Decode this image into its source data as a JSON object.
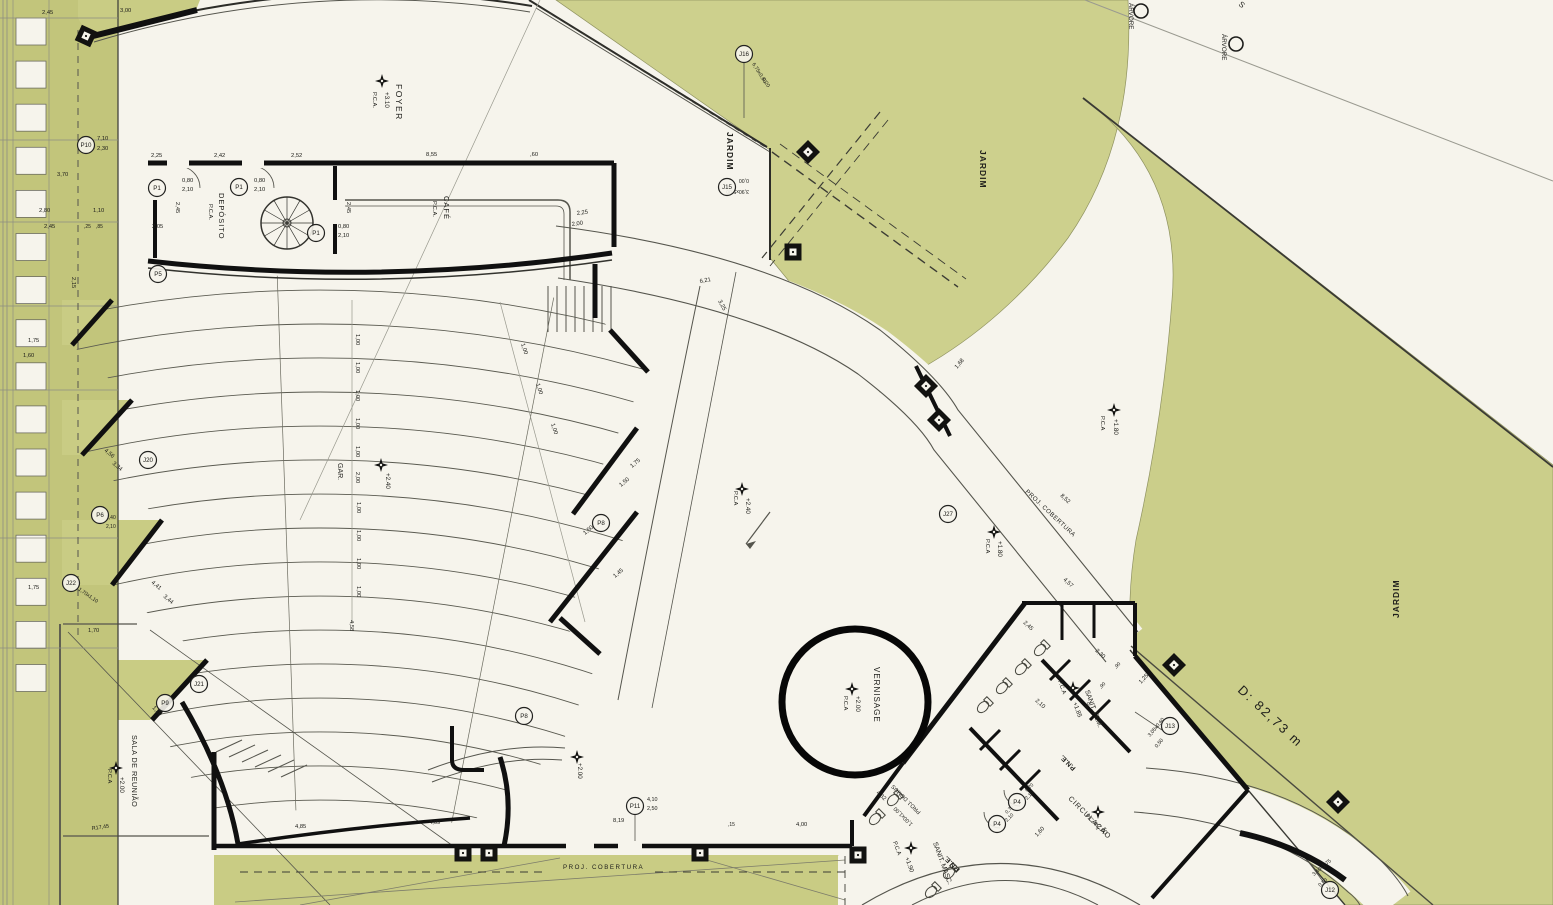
{
  "plan": {
    "colors": {
      "paper": "#f6f4ec",
      "green": "#c9cc84",
      "green_light": "#cdd08d",
      "green_dark": "#c2c57b",
      "ink": "#141414",
      "line": "#4a4a4a",
      "dim_text": "#2b2b26"
    },
    "distance_note": "D: 82,73 m",
    "rooms": [
      "FOYER",
      "DEPÓSITO",
      "CAFÉ",
      "GAR.",
      "JARDIM",
      "VERNISAGE",
      "SALA DE REUNIÃO",
      "SANIT. FEM.",
      "SANIT. MASC.",
      "P.N.E.",
      "CIRCULAÇÃO"
    ],
    "texts": [
      {
        "t": "FOYER",
        "x": 396,
        "y": 84,
        "r": 90,
        "s": 8.5,
        "ls": 1.5
      },
      {
        "t": "+3.10",
        "x": 385,
        "y": 92,
        "r": 90,
        "s": 6.3
      },
      {
        "t": "P.C.A.",
        "x": 373,
        "y": 92,
        "r": 90,
        "s": 5.8
      },
      {
        "t": "DEPÓSITO",
        "x": 219,
        "y": 193,
        "r": 90,
        "s": 7.5,
        "ls": 1
      },
      {
        "t": "P.C.A.",
        "x": 209,
        "y": 204,
        "r": 90,
        "s": 5.8
      },
      {
        "t": "CAFÉ",
        "x": 444,
        "y": 196,
        "r": 90,
        "s": 7.5,
        "ls": 1
      },
      {
        "t": "P.C.A.",
        "x": 433,
        "y": 201,
        "r": 90,
        "s": 5.8
      },
      {
        "t": "GAR.",
        "x": 338,
        "y": 463,
        "r": 90,
        "s": 7
      },
      {
        "t": "+2.40",
        "x": 386,
        "y": 473,
        "r": 90,
        "s": 6.3
      },
      {
        "t": "JARDIM",
        "x": 727,
        "y": 132,
        "r": 90,
        "s": 8.5,
        "w": "bold",
        "ls": 1
      },
      {
        "t": "JARDIM",
        "x": 980,
        "y": 150,
        "r": 90,
        "s": 8.5,
        "w": "bold",
        "ls": 1
      },
      {
        "t": "JARDIM",
        "x": 1399,
        "y": 618,
        "r": -90,
        "s": 8.5,
        "w": "bold",
        "ls": 1
      },
      {
        "t": "ÁRVORE",
        "x": 1129,
        "y": 3,
        "r": 90,
        "s": 6.3
      },
      {
        "t": "ÁRVORE",
        "x": 1222,
        "y": 34,
        "r": 90,
        "s": 6.3
      },
      {
        "t": "VERNISAGE",
        "x": 874,
        "y": 667,
        "r": 90,
        "s": 8,
        "ls": 1
      },
      {
        "t": "+2.00",
        "x": 856,
        "y": 696,
        "r": 90,
        "s": 6.3
      },
      {
        "t": "P.C.A",
        "x": 844,
        "y": 696,
        "r": 90,
        "s": 5.8
      },
      {
        "t": "SALA DE REUNIÃO",
        "x": 132,
        "y": 735,
        "r": 90,
        "s": 7.2,
        "ls": 0.5
      },
      {
        "t": "+2.00",
        "x": 120,
        "y": 777,
        "r": 90,
        "s": 6.3
      },
      {
        "t": "P.C.A",
        "x": 108,
        "y": 769,
        "r": 90,
        "s": 5.8
      },
      {
        "t": "SANIT. FEM.",
        "x": 1085,
        "y": 691,
        "r": 70,
        "s": 6.8
      },
      {
        "t": "+1.85",
        "x": 1073,
        "y": 703,
        "r": 70,
        "s": 6.2
      },
      {
        "t": "P.C.A",
        "x": 1058,
        "y": 681,
        "r": 70,
        "s": 5.8
      },
      {
        "t": "SANIT. MASC.",
        "x": 933,
        "y": 843,
        "r": 70,
        "s": 6.8
      },
      {
        "t": "+1.90",
        "x": 905,
        "y": 858,
        "r": 70,
        "s": 6.2
      },
      {
        "t": "P.C.A",
        "x": 893,
        "y": 842,
        "r": 70,
        "s": 5.8
      },
      {
        "t": "P.N.E.",
        "x": 1076,
        "y": 768,
        "r": -135,
        "s": 6.8,
        "w": "bold"
      },
      {
        "t": "P.N.E.",
        "x": 960,
        "y": 869,
        "r": -135,
        "s": 6.8,
        "w": "bold"
      },
      {
        "t": "CIRCULAÇÃO",
        "x": 1068,
        "y": 799,
        "r": 45,
        "s": 7.2,
        "ls": 1
      },
      {
        "t": "+2.00",
        "x": 1094,
        "y": 824,
        "r": 45,
        "s": 6.2
      },
      {
        "t": "P.C.A",
        "x": 1085,
        "y": 816,
        "r": 45,
        "s": 5.8
      },
      {
        "t": "PROJ. DOMUS",
        "x": 921,
        "y": 812,
        "r": -135,
        "s": 5.6
      },
      {
        "t": "1,00x1,00",
        "x": 913,
        "y": 824,
        "r": -135,
        "s": 5.6
      },
      {
        "t": "PROJ. COBERTURA",
        "x": 563,
        "y": 869,
        "r": 0,
        "s": 6.2,
        "ls": 1.5
      },
      {
        "t": "PROJ. COBERTURA",
        "x": 1025,
        "y": 492,
        "r": 43,
        "s": 6.2,
        "ls": 0.5
      },
      {
        "t": "+2.00",
        "x": 578,
        "y": 763,
        "r": 90,
        "s": 6.2
      },
      {
        "t": "P.C.A",
        "x": 734,
        "y": 491,
        "r": 90,
        "s": 5.8
      },
      {
        "t": "+2.40",
        "x": 746,
        "y": 498,
        "r": 90,
        "s": 6.3
      },
      {
        "t": "P.C.A",
        "x": 1101,
        "y": 416,
        "r": 90,
        "s": 5.8
      },
      {
        "t": "+1.80",
        "x": 1114,
        "y": 419,
        "r": 90,
        "s": 6.3
      },
      {
        "t": "P.C.A",
        "x": 986,
        "y": 539,
        "r": 90,
        "s": 5.8
      },
      {
        "t": "+1.80",
        "x": 998,
        "y": 541,
        "r": 90,
        "s": 6.3
      },
      {
        "t": "D: 82,73 m",
        "x": 1237,
        "y": 691,
        "r": 43,
        "s": 13,
        "c": "#55523d",
        "ls": 2
      },
      {
        "t": "S",
        "x": 1238,
        "y": 5,
        "r": 40,
        "s": 8,
        "c": "#777770"
      },
      {
        "t": "2,45",
        "x": 42,
        "y": 14
      },
      {
        "t": "3,00",
        "x": 120,
        "y": 12
      },
      {
        "t": "7,10",
        "x": 97,
        "y": 140
      },
      {
        "t": "2,30",
        "x": 97,
        "y": 150
      },
      {
        "t": "3,70",
        "x": 57,
        "y": 176
      },
      {
        "t": "2,80",
        "x": 39,
        "y": 212
      },
      {
        "t": "1,10",
        "x": 93,
        "y": 212
      },
      {
        "t": "2,45",
        "x": 44,
        "y": 228
      },
      {
        "t": ",25",
        "x": 84,
        "y": 228,
        "s": 5
      },
      {
        "t": ",85",
        "x": 96,
        "y": 228,
        "s": 5
      },
      {
        "t": "2,15",
        "x": 72,
        "y": 277,
        "r": 90
      },
      {
        "t": "1,75",
        "x": 28,
        "y": 342
      },
      {
        "t": "1,60",
        "x": 23,
        "y": 357
      },
      {
        "t": "2,25",
        "x": 151,
        "y": 157
      },
      {
        "t": "2,42",
        "x": 214,
        "y": 157
      },
      {
        "t": "2,52",
        "x": 291,
        "y": 157
      },
      {
        "t": "8,55",
        "x": 426,
        "y": 156
      },
      {
        "t": ",60",
        "x": 530,
        "y": 156
      },
      {
        "t": "0,80",
        "x": 182,
        "y": 182
      },
      {
        "t": "2,10",
        "x": 182,
        "y": 191
      },
      {
        "t": "0,80",
        "x": 254,
        "y": 182
      },
      {
        "t": "2,10",
        "x": 254,
        "y": 191
      },
      {
        "t": "0,80",
        "x": 338,
        "y": 228
      },
      {
        "t": "2,10",
        "x": 338,
        "y": 237
      },
      {
        "t": "2,05",
        "x": 152,
        "y": 228
      },
      {
        "t": "2,45",
        "x": 176,
        "y": 202,
        "r": 90
      },
      {
        "t": "2,45",
        "x": 347,
        "y": 202,
        "r": 90
      },
      {
        "t": "2,25",
        "x": 577,
        "y": 215,
        "r": -8
      },
      {
        "t": "2,00",
        "x": 572,
        "y": 226,
        "r": -8
      },
      {
        "t": "6,21",
        "x": 700,
        "y": 283,
        "r": -10
      },
      {
        "t": "3,25",
        "x": 718,
        "y": 301,
        "r": 62
      },
      {
        "t": "1,00",
        "x": 356,
        "y": 334,
        "r": 90
      },
      {
        "t": "1,00",
        "x": 356,
        "y": 362,
        "r": 90
      },
      {
        "t": "1,00",
        "x": 356,
        "y": 390,
        "r": 90
      },
      {
        "t": "1,00",
        "x": 356,
        "y": 418,
        "r": 90
      },
      {
        "t": "1,00",
        "x": 356,
        "y": 446,
        "r": 90
      },
      {
        "t": "2,00",
        "x": 356,
        "y": 472,
        "r": 90
      },
      {
        "t": "1,00",
        "x": 357,
        "y": 502,
        "r": 90
      },
      {
        "t": "1,00",
        "x": 357,
        "y": 530,
        "r": 90
      },
      {
        "t": "1,00",
        "x": 357,
        "y": 558,
        "r": 90
      },
      {
        "t": "1,00",
        "x": 357,
        "y": 586,
        "r": 90
      },
      {
        "t": "4,58",
        "x": 350,
        "y": 620,
        "r": 90
      },
      {
        "t": "1,00",
        "x": 521,
        "y": 344,
        "r": 72
      },
      {
        "t": "1,00",
        "x": 536,
        "y": 384,
        "r": 72
      },
      {
        "t": "1,00",
        "x": 551,
        "y": 424,
        "r": 72
      },
      {
        "t": "1,75",
        "x": 632,
        "y": 468,
        "r": -40
      },
      {
        "t": "1,50",
        "x": 621,
        "y": 487,
        "r": -40
      },
      {
        "t": "1,50",
        "x": 585,
        "y": 535,
        "r": -40
      },
      {
        "t": "1,45",
        "x": 615,
        "y": 578,
        "r": -40
      },
      {
        "t": "4,56",
        "x": 104,
        "y": 451,
        "r": 40
      },
      {
        "t": "3,34",
        "x": 112,
        "y": 464,
        "r": 40
      },
      {
        "t": "4,41",
        "x": 151,
        "y": 583,
        "r": 40
      },
      {
        "t": "3,44",
        "x": 163,
        "y": 597,
        "r": 40
      },
      {
        "t": "1,70x1,10",
        "x": 78,
        "y": 590,
        "r": 35,
        "s": 5.2
      },
      {
        "t": "1,70",
        "x": 88,
        "y": 632
      },
      {
        "t": "1,75",
        "x": 28,
        "y": 589
      },
      {
        "t": "1,20",
        "x": 152,
        "y": 708,
        "r": 45
      },
      {
        "t": "1,40",
        "x": 106,
        "y": 519,
        "s": 5
      },
      {
        "t": "2,10",
        "x": 106,
        "y": 528,
        "s": 5
      },
      {
        "t": "4,85",
        "x": 295,
        "y": 828
      },
      {
        "t": "4,09",
        "x": 429,
        "y": 824
      },
      {
        "t": "8,19",
        "x": 613,
        "y": 822
      },
      {
        "t": "4,00",
        "x": 796,
        "y": 826
      },
      {
        "t": ",15",
        "x": 728,
        "y": 826,
        "s": 5
      },
      {
        "t": "R17,45",
        "x": 92,
        "y": 830,
        "r": -8,
        "s": 5.4
      },
      {
        "t": "8,52",
        "x": 1060,
        "y": 496,
        "r": 43
      },
      {
        "t": "4,57",
        "x": 1063,
        "y": 580,
        "r": 43
      },
      {
        "t": "2,45",
        "x": 1023,
        "y": 623,
        "r": 43
      },
      {
        "t": "2,30",
        "x": 1095,
        "y": 651,
        "r": 43
      },
      {
        "t": "2,10",
        "x": 1035,
        "y": 701,
        "r": 43
      },
      {
        "t": "1,25",
        "x": 1141,
        "y": 684,
        "r": -47
      },
      {
        "t": ",90",
        "x": 1116,
        "y": 669,
        "r": -47,
        "s": 5
      },
      {
        "t": ",90",
        "x": 1101,
        "y": 689,
        "r": -47,
        "s": 5
      },
      {
        "t": ",90",
        "x": 1086,
        "y": 709,
        "r": -47,
        "s": 5
      },
      {
        "t": "1,60",
        "x": 1037,
        "y": 837,
        "r": -47
      },
      {
        "t": "4,32",
        "x": 876,
        "y": 793,
        "r": 43
      },
      {
        "t": "1,68",
        "x": 957,
        "y": 369,
        "r": -50
      },
      {
        "t": "6,75x0,60",
        "x": 752,
        "y": 64,
        "r": 58,
        "s": 5.2
      },
      {
        "t": "0,20",
        "x": 762,
        "y": 79,
        "r": 58,
        "s": 5.2
      },
      {
        "t": "0,00",
        "x": 749,
        "y": 179,
        "r": 180,
        "s": 5.2
      },
      {
        "t": "3,90x5,00",
        "x": 749,
        "y": 190,
        "r": 180,
        "s": 5.2
      },
      {
        "t": "3,05x0,60",
        "x": 1150,
        "y": 737,
        "r": -50,
        "s": 5.2
      },
      {
        "t": "0,50",
        "x": 1157,
        "y": 748,
        "r": -50,
        "s": 5.2
      },
      {
        "t": "3,40x1,75",
        "x": 1314,
        "y": 876,
        "r": -40,
        "s": 5.2
      },
      {
        "t": "0,50",
        "x": 1320,
        "y": 887,
        "r": -40,
        "s": 5.2
      },
      {
        "t": "4,10",
        "x": 647,
        "y": 801,
        "s": 5.4
      },
      {
        "t": "2,50",
        "x": 647,
        "y": 810,
        "s": 5.4
      },
      {
        "t": "0,70",
        "x": 1027,
        "y": 792,
        "r": -45,
        "s": 5
      },
      {
        "t": "2,10",
        "x": 1027,
        "y": 800,
        "r": -45,
        "s": 5
      },
      {
        "t": "0,70",
        "x": 1007,
        "y": 814,
        "r": -45,
        "s": 5
      },
      {
        "t": "2,10",
        "x": 1007,
        "y": 822,
        "r": -45,
        "s": 5
      }
    ],
    "tags": [
      {
        "id": "P1",
        "x": 157,
        "y": 188
      },
      {
        "id": "P1",
        "x": 239,
        "y": 187
      },
      {
        "id": "P1",
        "x": 316,
        "y": 233
      },
      {
        "id": "P5",
        "x": 158,
        "y": 274
      },
      {
        "id": "P10",
        "x": 86,
        "y": 145
      },
      {
        "id": "P6",
        "x": 100,
        "y": 515
      },
      {
        "id": "P8",
        "x": 601,
        "y": 523
      },
      {
        "id": "P8",
        "x": 524,
        "y": 716
      },
      {
        "id": "P9",
        "x": 165,
        "y": 703
      },
      {
        "id": "P11",
        "x": 635,
        "y": 806
      },
      {
        "id": "P4",
        "x": 1017,
        "y": 802
      },
      {
        "id": "P4",
        "x": 997,
        "y": 824
      },
      {
        "id": "J20",
        "x": 148,
        "y": 460
      },
      {
        "id": "J21",
        "x": 199,
        "y": 684
      },
      {
        "id": "J22",
        "x": 71,
        "y": 583
      },
      {
        "id": "J27",
        "x": 948,
        "y": 514
      },
      {
        "id": "J13",
        "x": 1170,
        "y": 726
      },
      {
        "id": "J15",
        "x": 727,
        "y": 187
      },
      {
        "id": "J16",
        "x": 744,
        "y": 54
      },
      {
        "id": "J12",
        "x": 1330,
        "y": 890
      }
    ],
    "trees": [
      {
        "label": "ÁRVORE",
        "x": 1141,
        "y": 11,
        "r": 7
      },
      {
        "label": "ÁRVORE",
        "x": 1236,
        "y": 44,
        "r": 7
      }
    ],
    "level_markers": [
      {
        "x": 382,
        "y": 81
      },
      {
        "x": 381,
        "y": 465
      },
      {
        "x": 742,
        "y": 489
      },
      {
        "x": 1114,
        "y": 410
      },
      {
        "x": 994,
        "y": 532
      },
      {
        "x": 852,
        "y": 689
      },
      {
        "x": 116,
        "y": 768
      },
      {
        "x": 1073,
        "y": 688
      },
      {
        "x": 911,
        "y": 848
      },
      {
        "x": 1098,
        "y": 812
      },
      {
        "x": 577,
        "y": 757
      }
    ],
    "fixtures": [
      [
        1040,
        650
      ],
      [
        1021,
        669
      ],
      [
        1002,
        688
      ],
      [
        983,
        707
      ],
      [
        893,
        800
      ],
      [
        875,
        819
      ],
      [
        949,
        873
      ],
      [
        931,
        892
      ]
    ],
    "column_squares": [
      [
        808,
        152,
        45
      ],
      [
        793,
        252,
        0
      ],
      [
        926,
        386,
        45
      ],
      [
        939,
        420,
        45
      ],
      [
        1174,
        665,
        45
      ],
      [
        1338,
        802,
        45
      ],
      [
        463,
        853,
        0
      ],
      [
        489,
        853,
        0
      ],
      [
        700,
        853,
        0
      ],
      [
        858,
        855,
        0
      ],
      [
        86,
        36,
        25
      ]
    ]
  }
}
